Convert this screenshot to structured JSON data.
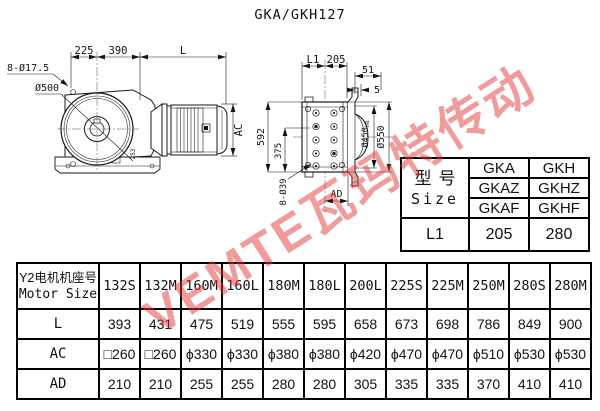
{
  "title": "GKA/GKH127",
  "watermark": {
    "text": "VEMTE瓦玛特传动"
  },
  "left_view": {
    "dim_225": "225",
    "dim_390": "390",
    "dim_l": "L",
    "bolt_callout": "8-Ø17.5",
    "dia_500": "Ø500",
    "dim_ac": "AC",
    "dim_253": "253"
  },
  "right_view": {
    "dim_l1": "L1",
    "dim_205": "205",
    "dim_51": "51",
    "dim_5": "5",
    "dim_592": "592",
    "dim_375": "375",
    "bolt_callout": "8-Ø39",
    "dia_450": "Ø450",
    "dia_450_tol": "h6",
    "dia_550": "Ø550",
    "dim_ad": "AD"
  },
  "size_table": {
    "header_cn": "型号",
    "header_en": "Size",
    "gka_col": [
      "GKA",
      "GKAZ",
      "GKAF"
    ],
    "gkh_col": [
      "GKH",
      "GKHZ",
      "GKHF"
    ],
    "l1_label": "L1",
    "l1_gka": "205",
    "l1_gkh": "280"
  },
  "motor_table": {
    "header_cn": "Y2电机机座号",
    "header_en": "Motor Size",
    "columns": [
      "132S",
      "132M",
      "160M",
      "160L",
      "180M",
      "180L",
      "200L",
      "225S",
      "225M",
      "250M",
      "280S",
      "280M"
    ],
    "rows": [
      {
        "label": "L",
        "values": [
          "393",
          "431",
          "475",
          "519",
          "555",
          "595",
          "658",
          "673",
          "698",
          "786",
          "849",
          "900"
        ]
      },
      {
        "label": "AC",
        "values": [
          "□260",
          "□260",
          "ϕ330",
          "ϕ330",
          "ϕ380",
          "ϕ380",
          "ϕ420",
          "ϕ470",
          "ϕ470",
          "ϕ510",
          "ϕ530",
          "ϕ530"
        ]
      },
      {
        "label": "AD",
        "values": [
          "210",
          "210",
          "255",
          "255",
          "280",
          "280",
          "305",
          "335",
          "335",
          "370",
          "410",
          "410"
        ]
      }
    ]
  }
}
